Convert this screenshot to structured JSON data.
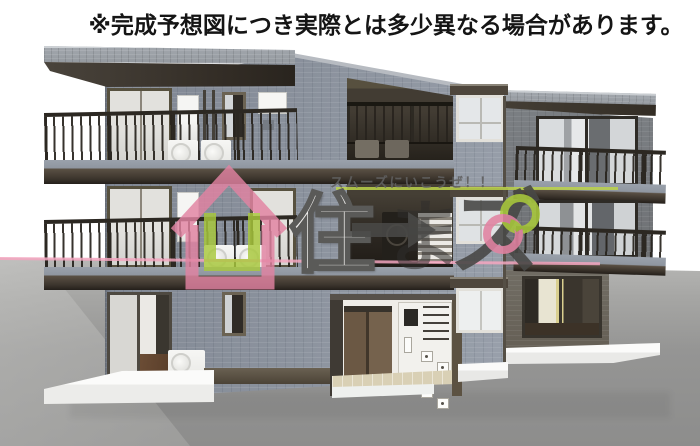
{
  "disclaimer": "※完成予想図につき実際とは多少異なる場合があります。",
  "watermark": {
    "tagline": "スムーズにいこうぜ！！",
    "logo_char_1": "住",
    "logo_char_2": "ま",
    "logo_char_3": "ズ"
  },
  "colors": {
    "sky": "#ffffff",
    "wall_tile": "#8a919c",
    "roof_dark": "#3a332c",
    "ground": "#9a9a99",
    "base_white": "#f3f3f1",
    "entrance_floor": "#d9d0b5",
    "pink": "#e283a2",
    "green": "#a9c93c",
    "line_pink": "#f3a6c0",
    "line_green": "#bcd34a",
    "text_gray": "#4a4a48",
    "text_white": "#eeedeb"
  }
}
